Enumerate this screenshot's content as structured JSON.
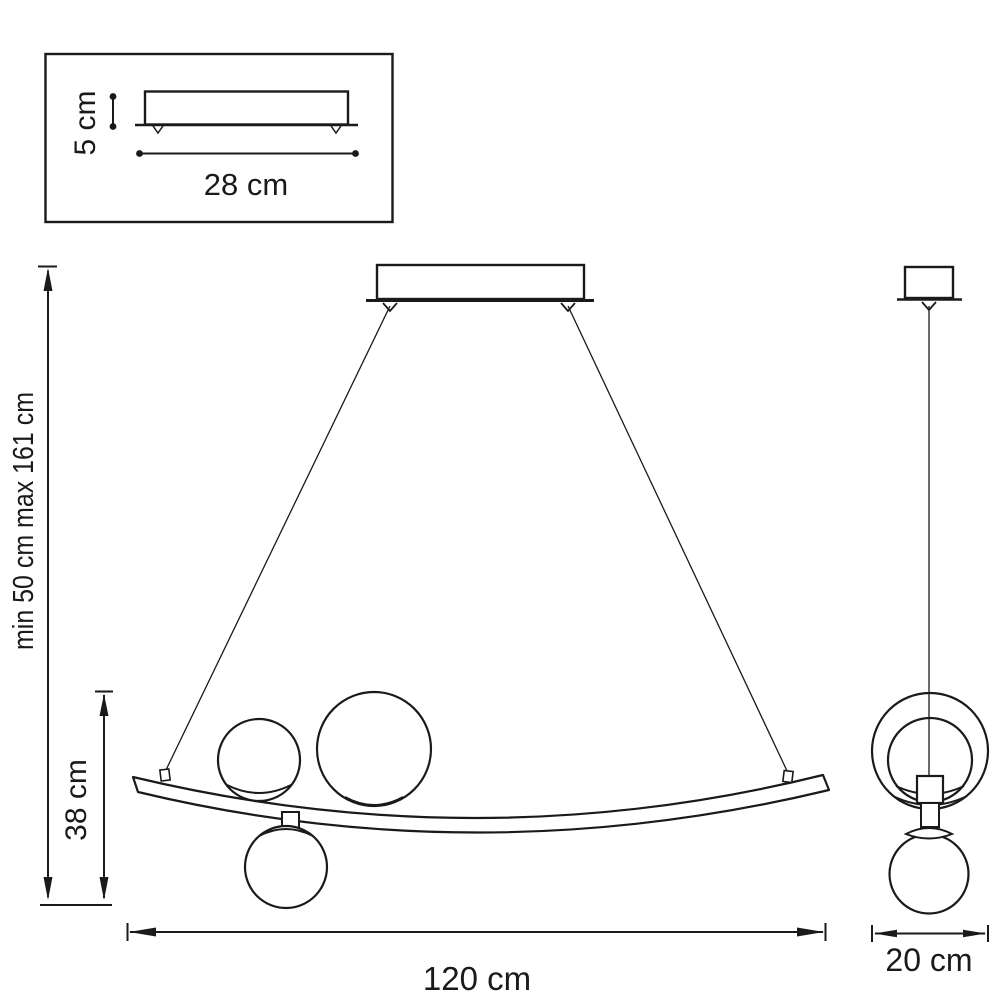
{
  "drawing": {
    "inset": {
      "height_label": "5 cm",
      "width_label": "28 cm"
    },
    "front": {
      "suspension_label": "min 50 cm max 161 cm",
      "fixture_height_label": "38 cm",
      "width_label": "120 cm"
    },
    "side": {
      "depth_label": "20 cm"
    }
  },
  "colors": {
    "line": "#1a1a1a",
    "background": "#ffffff"
  }
}
